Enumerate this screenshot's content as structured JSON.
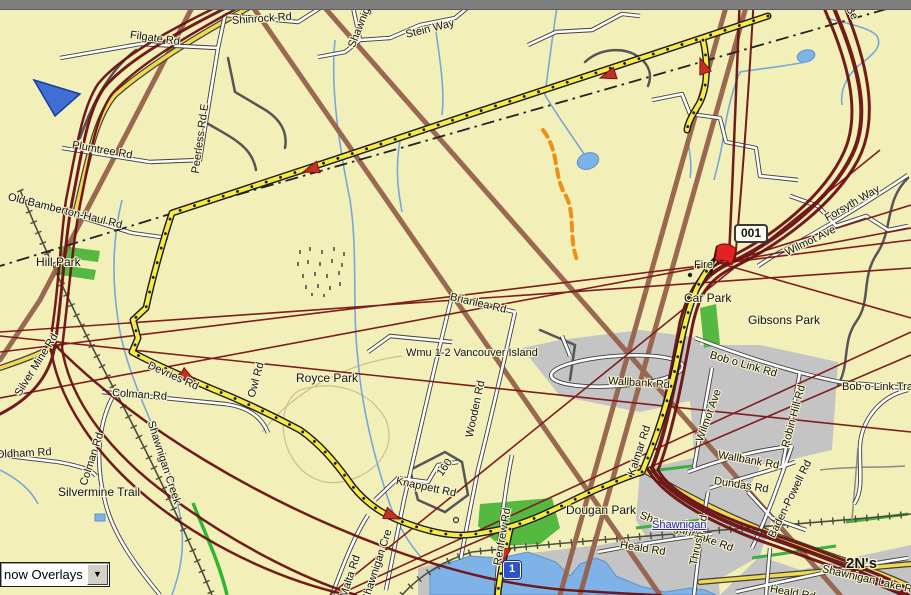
{
  "window": {
    "top_bar": "window-chrome-strip"
  },
  "overlay_control": {
    "visible_text": "now Overlays",
    "icon": "chevron-down-icon"
  },
  "map": {
    "background_color": "#F2EFB8",
    "icons": {
      "waypoint": "red-flag-icon",
      "position_marker": "blue-triangle-icon",
      "highway_marker": "highway-1-shield",
      "route_direction": "red-arrow-icon",
      "poi": "fire-station-dot"
    },
    "colors": {
      "route_yellow": "#F7EA43",
      "track_maroon": "#6B1113",
      "road_brown": "#96614B",
      "water_blue": "#7FB2E6",
      "urban_gray": "#C4C4C4",
      "park_green": "#55B840",
      "trail_orange": "#EE9018"
    },
    "labels": [
      {
        "text": "Filgate Rd",
        "x": 130,
        "y": 30,
        "r": 8,
        "c": "road"
      },
      {
        "text": "Shinrock Rd",
        "x": 232,
        "y": 16,
        "r": -4,
        "c": "road"
      },
      {
        "text": "Shawnig",
        "x": 352,
        "y": 42,
        "r": -68,
        "c": "road"
      },
      {
        "text": "Stein Way",
        "x": 406,
        "y": 30,
        "r": -14,
        "c": "road"
      },
      {
        "text": "Be",
        "x": 848,
        "y": 2,
        "r": 60,
        "c": "road"
      },
      {
        "text": "Plumtree Rd",
        "x": 72,
        "y": 140,
        "r": 10,
        "c": "road"
      },
      {
        "text": "Peerless Rd E",
        "x": 196,
        "y": 168,
        "r": -82,
        "c": "road"
      },
      {
        "text": "Old Bamberton-Haul Rd",
        "x": 8,
        "y": 192,
        "r": 14,
        "c": "road"
      },
      {
        "text": "Hill Park",
        "x": 36,
        "y": 256,
        "r": 0,
        "c": "park"
      },
      {
        "text": "Silver Mine Rd",
        "x": 18,
        "y": 390,
        "r": -58,
        "c": "road"
      },
      {
        "text": "Colman Rd",
        "x": 112,
        "y": 388,
        "r": 4,
        "c": "road"
      },
      {
        "text": "Oldham Rd",
        "x": -4,
        "y": 450,
        "r": -3,
        "c": "road"
      },
      {
        "text": "Colman Rd",
        "x": 84,
        "y": 480,
        "r": -72,
        "c": "road"
      },
      {
        "text": "Silvermine Trail",
        "x": 58,
        "y": 486,
        "r": 0,
        "c": "park"
      },
      {
        "text": "Shawnigan Creek",
        "x": 150,
        "y": 416,
        "r": 72,
        "c": "road"
      },
      {
        "text": "Malta Rd",
        "x": 344,
        "y": 592,
        "r": -72,
        "c": "road"
      },
      {
        "text": "Shawnigan Cre",
        "x": 366,
        "y": 596,
        "r": -72,
        "c": "road"
      },
      {
        "text": "Knappett Rd",
        "x": 396,
        "y": 476,
        "r": 12,
        "c": "road"
      },
      {
        "text": "160",
        "x": 440,
        "y": 470,
        "r": -55,
        "c": "road"
      },
      {
        "text": "Brianlea Rd",
        "x": 450,
        "y": 292,
        "r": 13,
        "c": "road"
      },
      {
        "text": "Wmu 1-2 Vancouver Island",
        "x": 406,
        "y": 348,
        "r": 0,
        "c": "road"
      },
      {
        "text": "Wooden Rd",
        "x": 470,
        "y": 432,
        "r": -78,
        "c": "road"
      },
      {
        "text": "Royce Park",
        "x": 296,
        "y": 372,
        "r": 0,
        "c": "park"
      },
      {
        "text": "Devries Rd",
        "x": 148,
        "y": 360,
        "r": 24,
        "c": "road"
      },
      {
        "text": "Owl Rd",
        "x": 252,
        "y": 392,
        "r": -75,
        "c": "road"
      },
      {
        "text": "Wallbank Rd",
        "x": 608,
        "y": 376,
        "r": 4,
        "c": "road"
      },
      {
        "text": "Kalmar Rd",
        "x": 632,
        "y": 470,
        "r": -72,
        "c": "road"
      },
      {
        "text": "Wilmot Ave",
        "x": 786,
        "y": 248,
        "r": -26,
        "c": "road"
      },
      {
        "text": "Forsyth Way",
        "x": 826,
        "y": 214,
        "r": -30,
        "c": "road"
      },
      {
        "text": "Bob o Link Rd",
        "x": 710,
        "y": 350,
        "r": 16,
        "c": "road"
      },
      {
        "text": "Bob o Link Tra",
        "x": 842,
        "y": 382,
        "r": 0,
        "c": "road"
      },
      {
        "text": "Wilmot Ave",
        "x": 700,
        "y": 436,
        "r": -70,
        "c": "road"
      },
      {
        "text": "Robin Hill Rd",
        "x": 786,
        "y": 442,
        "r": -75,
        "c": "road"
      },
      {
        "text": "Wallbank Rd",
        "x": 718,
        "y": 450,
        "r": 10,
        "c": "road"
      },
      {
        "text": "Dundas Rd",
        "x": 714,
        "y": 476,
        "r": 9,
        "c": "road"
      },
      {
        "text": "Baden-Powell Rd",
        "x": 772,
        "y": 532,
        "r": -64,
        "c": "road"
      },
      {
        "text": "Shawnigan Lake Rd",
        "x": 640,
        "y": 510,
        "r": 20,
        "c": "road"
      },
      {
        "text": "Thrush Rd",
        "x": 694,
        "y": 560,
        "r": -78,
        "c": "road"
      },
      {
        "text": "Heald Rd",
        "x": 620,
        "y": 540,
        "r": 9,
        "c": "road"
      },
      {
        "text": "Heald Rd",
        "x": 770,
        "y": 584,
        "r": 10,
        "c": "road"
      },
      {
        "text": "Shawnigan Lake Rd",
        "x": 822,
        "y": 564,
        "r": 13,
        "c": "road"
      },
      {
        "text": "Renfrew Rd",
        "x": 498,
        "y": 560,
        "r": -80,
        "c": "road"
      },
      {
        "text": "Dougan Park",
        "x": 566,
        "y": 504,
        "r": 0,
        "c": "park"
      },
      {
        "text": "Car Park",
        "x": 684,
        "y": 292,
        "r": 0,
        "c": "park"
      },
      {
        "text": "Gibsons Park",
        "x": 748,
        "y": 314,
        "r": 0,
        "c": "park"
      },
      {
        "text": "Fire",
        "x": 694,
        "y": 260,
        "r": 0,
        "c": "road"
      },
      {
        "text": "2N's",
        "x": 846,
        "y": 556,
        "r": 0,
        "c": "bold2"
      },
      {
        "text": "Shawnigan",
        "x": 652,
        "y": 520,
        "r": 0,
        "c": "city"
      },
      {
        "text": "001",
        "x": 734,
        "y": 224,
        "r": 0,
        "c": "waypoint"
      },
      {
        "text": "1",
        "x": 503,
        "y": 561,
        "r": 0,
        "c": "shield"
      }
    ]
  }
}
